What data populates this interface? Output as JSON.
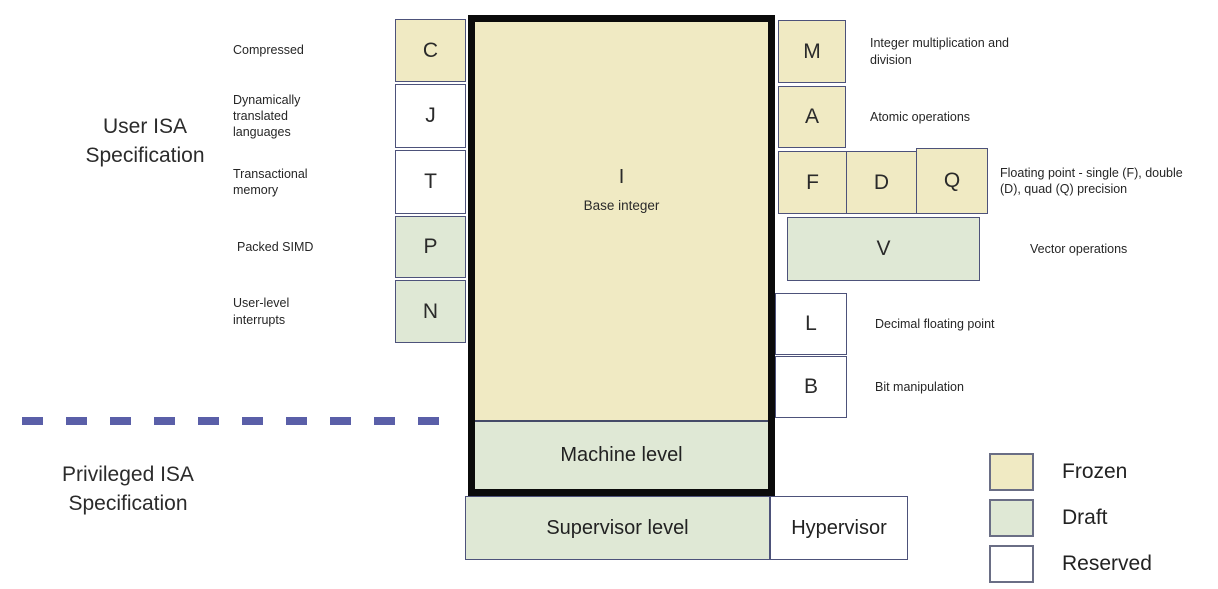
{
  "sections": {
    "user": {
      "label": "User ISA Specification"
    },
    "privileged": {
      "label": "Privileged ISA Specification"
    }
  },
  "base_box": {
    "letter": "I",
    "label": "Base integer"
  },
  "left_extensions": [
    {
      "letter": "C",
      "label": "Compressed",
      "status": "frozen"
    },
    {
      "letter": "J",
      "label": "Dynamically translated languages",
      "status": "reserved"
    },
    {
      "letter": "T",
      "label": "Transactional memory",
      "status": "reserved"
    },
    {
      "letter": "P",
      "label": "Packed SIMD",
      "status": "draft"
    },
    {
      "letter": "N",
      "label": "User-level interrupts",
      "status": "draft"
    }
  ],
  "right_extensions": [
    {
      "letter": "M",
      "label": "Integer multiplication and division",
      "status": "frozen"
    },
    {
      "letter": "A",
      "label": "Atomic operations",
      "status": "frozen"
    },
    {
      "letter": "F",
      "status": "frozen"
    },
    {
      "letter": "D",
      "status": "frozen"
    },
    {
      "letter": "Q",
      "status": "frozen"
    },
    {
      "letter": "V",
      "label": "Vector operations",
      "status": "draft"
    },
    {
      "letter": "L",
      "label": "Decimal floating point",
      "status": "reserved"
    },
    {
      "letter": "B",
      "label": "Bit manipulation",
      "status": "reserved"
    }
  ],
  "fdq_label": "Floating point - single (F), double (D), quad (Q) precision",
  "privilege_levels": [
    {
      "label": "Machine level",
      "status": "draft"
    },
    {
      "label": "Supervisor level",
      "status": "draft"
    },
    {
      "label": "Hypervisor",
      "status": "reserved"
    }
  ],
  "legend": [
    {
      "label": "Frozen",
      "status": "frozen",
      "color": "#f0eac3"
    },
    {
      "label": "Draft",
      "status": "draft",
      "color": "#dfe8d5"
    },
    {
      "label": "Reserved",
      "status": "reserved",
      "color": "#ffffff"
    }
  ],
  "colors": {
    "frozen_fill": "#f0eac3",
    "draft_fill": "#dfe8d5",
    "reserved_fill": "#ffffff",
    "box_border": "#4d527a",
    "thick_border": "#0b0b0b",
    "divider_dash": "#5a5fa8"
  }
}
